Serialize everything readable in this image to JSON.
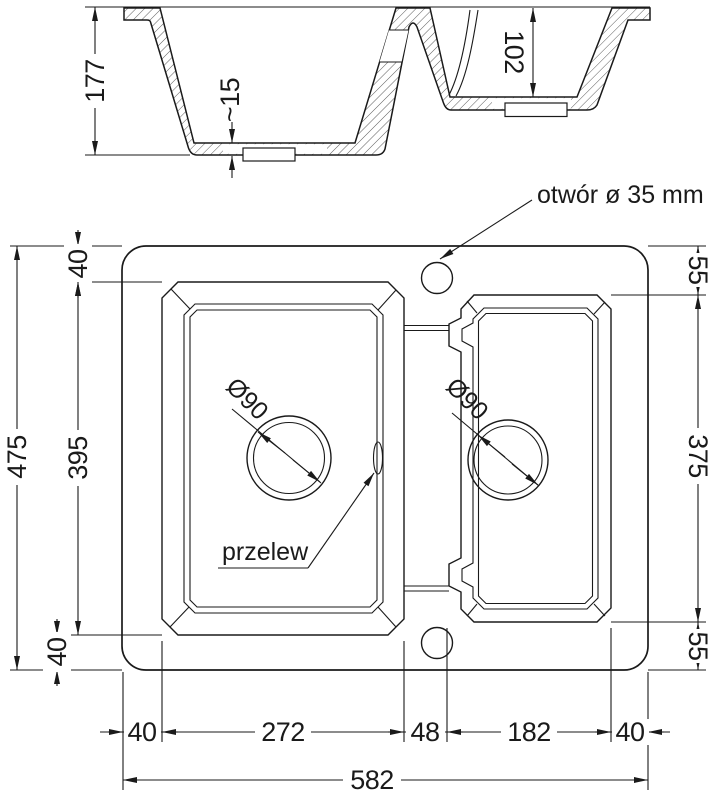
{
  "drawing": {
    "title_context": "sink technical drawing",
    "colors": {
      "line": "#1a1a1a",
      "background": "#ffffff"
    },
    "labels": {
      "hole_note": "otwór ø 35 mm",
      "overflow": "przelew",
      "drain_left": "Ø90",
      "drain_right": "Ø90"
    },
    "section": {
      "depth_main": "177",
      "depth_small": "102",
      "floor_thickness": "~15"
    },
    "plan": {
      "height_overall": "475",
      "height_bowl_left": "395",
      "offset_top_left": "40",
      "offset_bottom_left": "40",
      "offset_top_right": "55",
      "height_bowl_right": "375",
      "offset_bottom_right": "55",
      "width_edge_left": "40",
      "width_bowl_left": "272",
      "width_divider": "48",
      "width_bowl_right": "182",
      "width_edge_right": "40",
      "width_overall": "582"
    }
  }
}
